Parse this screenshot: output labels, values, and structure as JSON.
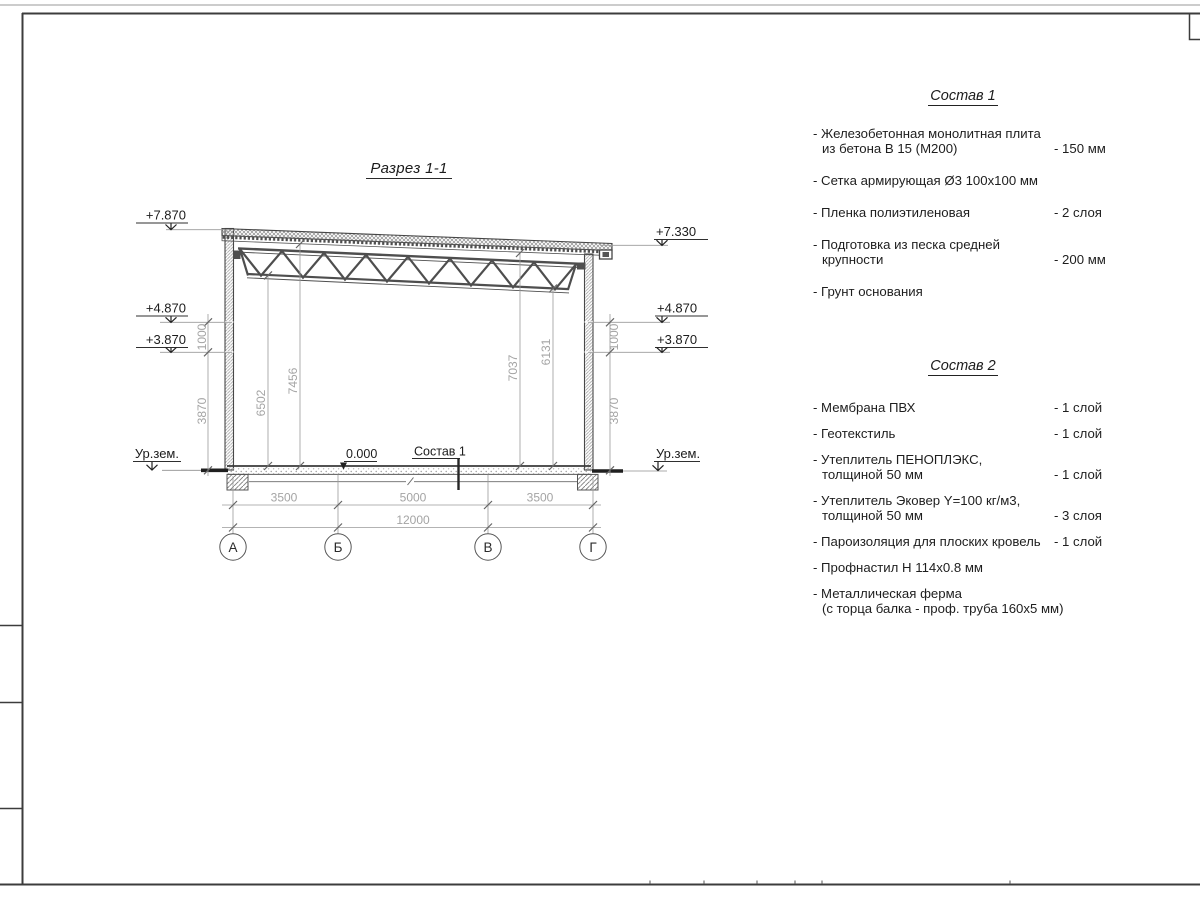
{
  "drawing": {
    "title": "Разрез 1-1",
    "elevation_marks": {
      "left": [
        "+7.870",
        "+4.870",
        "+3.870",
        "Ур.зем."
      ],
      "right": [
        "+7.330",
        "+4.870",
        "+3.870",
        "Ур.зем."
      ]
    },
    "zero_mark": "0.000",
    "floor_callout": "Состав 1",
    "dims": {
      "left_wall": [
        "1000",
        "3870"
      ],
      "right_wall": [
        "1000",
        "3870"
      ],
      "interior": [
        "6502",
        "7456",
        "7037",
        "6131"
      ],
      "spans": [
        "3500",
        "5000",
        "3500"
      ],
      "total": "12000"
    },
    "axes": [
      "А",
      "Б",
      "В",
      "Г"
    ]
  },
  "spec1": {
    "title": "Состав 1",
    "items": [
      {
        "line1": "- Железобетонная монолитная плита",
        "line2": "из бетона В 15 (М200)",
        "value": "- 150 мм"
      },
      {
        "line1": "- Сетка армирующая Ø3 100х100 мм",
        "line2": "",
        "value": ""
      },
      {
        "line1": "- Пленка полиэтиленовая",
        "line2": "",
        "value": "- 2 слоя"
      },
      {
        "line1": "- Подготовка из песка средней",
        "line2": "крупности",
        "value": "- 200 мм"
      },
      {
        "line1": "- Грунт основания",
        "line2": "",
        "value": ""
      }
    ]
  },
  "spec2": {
    "title": "Состав 2",
    "items": [
      {
        "line1": "- Мембрана ПВХ",
        "line2": "",
        "value": "- 1 слой"
      },
      {
        "line1": "- Геотекстиль",
        "line2": "",
        "value": "- 1 слой"
      },
      {
        "line1": "- Утеплитель ПЕНОПЛЭКС,",
        "line2": "толщиной 50 мм",
        "value": "- 1 слой"
      },
      {
        "line1": "- Утеплитель Эковер Y=100 кг/м3,",
        "line2": "толщиной 50 мм",
        "value": "- 3 слоя"
      },
      {
        "line1": "- Пароизоляция для плоских кровель",
        "line2": "",
        "value": "- 1 слой"
      },
      {
        "line1": "- Профнастил Н 114х0.8 мм",
        "line2": "",
        "value": ""
      },
      {
        "line1": "- Металлическая ферма",
        "line2": "(с торца балка - проф. труба 160х5 мм)",
        "value": ""
      }
    ]
  },
  "colors": {
    "linework": "#3f3f3f",
    "dim_text": "#a4a4a4",
    "body_text": "#1c1c1c",
    "hatch": "#9a9a9a",
    "paper": "#ffffff"
  }
}
